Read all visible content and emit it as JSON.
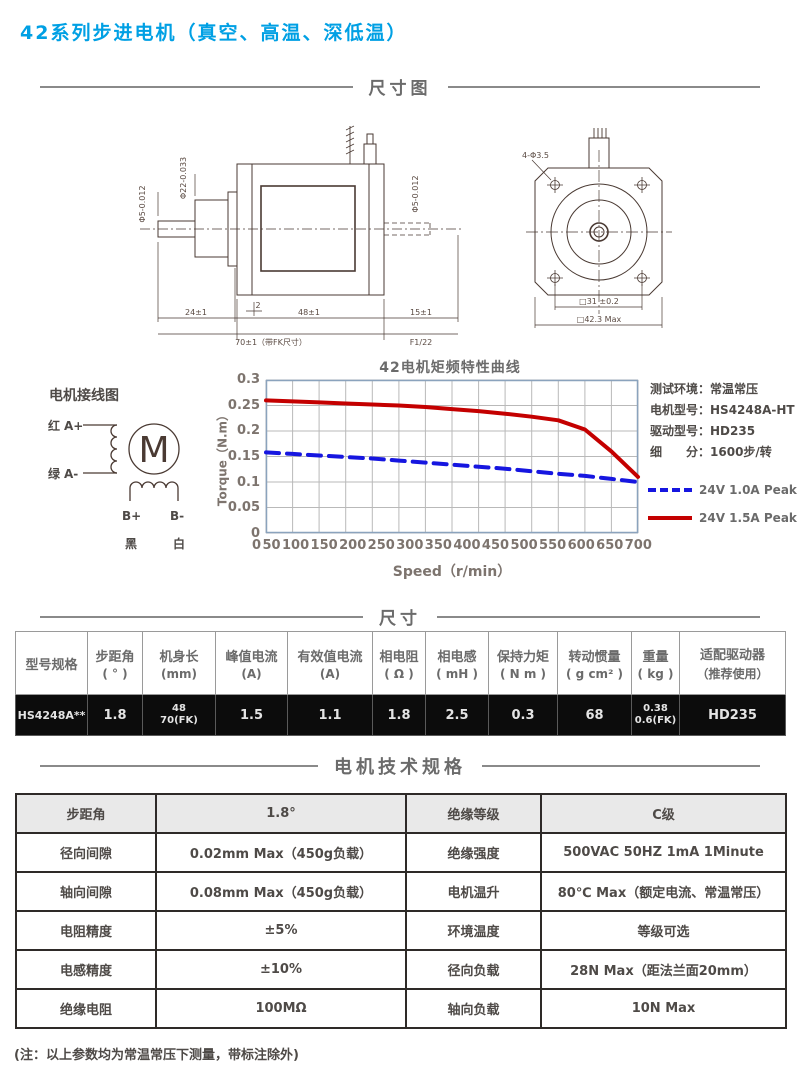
{
  "page": {
    "title": "42系列步进电机（真空、高温、深低温）",
    "footnote": "(注：以上参数均为常温常压下测量，带标注除外)"
  },
  "sections": {
    "dimension_drawing": "尺寸图",
    "dimensions": "尺寸",
    "motor_specs": "电机技术规格"
  },
  "colors": {
    "accent_blue": "#00a0e4",
    "curve_red": "#c40000",
    "curve_blue": "#1616e0",
    "grid_gray": "#b9b9b9",
    "frame_blue_gray": "#8ba3bd"
  },
  "drawing": {
    "side_view": {
      "shaft_dia": "Φ5-0.012",
      "boss_dia": "Φ22-0.033",
      "rear_shaft_dia": "Φ5-0.012",
      "dim_boss": "24±1",
      "dim_plate": "2",
      "dim_body": "48±1",
      "dim_total": "70±1（带FK尺寸）",
      "dim_shaft": "15±1",
      "dim_note": "F1/22"
    },
    "front_view": {
      "hole_label": "4-Φ3.5",
      "hole_pitch": "□31 ±0.2",
      "body_size": "□42.3 Max"
    }
  },
  "wiring": {
    "title": "电机接线图",
    "motor_letter": "M",
    "red": "红",
    "a_plus": "A+",
    "green": "绿",
    "a_minus": "A-",
    "b_plus": "B+",
    "b_minus": "B-",
    "black": "黑",
    "white": "白"
  },
  "chart_info": {
    "rows": [
      {
        "label": "测试环境：",
        "value": "常温常压"
      },
      {
        "label": "电机型号：",
        "value": "HS4248A-HT"
      },
      {
        "label": "驱动型号：",
        "value": "HD235"
      },
      {
        "label": "细　　分：",
        "value": "1600步/转"
      }
    ]
  },
  "chart_data": {
    "type": "line",
    "title": "42电机矩频特性曲线",
    "xlabel": "Speed（r/min）",
    "ylabel": "Torque（N.m）",
    "x": [
      0,
      50,
      100,
      150,
      200,
      250,
      300,
      350,
      400,
      450,
      500,
      550,
      600,
      650,
      700
    ],
    "xlim": [
      0,
      700
    ],
    "ylim": [
      0,
      0.3
    ],
    "y_ticks": [
      0,
      0.05,
      0.1,
      0.15,
      0.2,
      0.25,
      0.3
    ],
    "grid": true,
    "legend_position": "right",
    "series": [
      {
        "name": "24V 1.0A Peak",
        "color": "#1616e0",
        "style": "dashed",
        "values": [
          0.158,
          0.155,
          0.152,
          0.149,
          0.146,
          0.142,
          0.138,
          0.134,
          0.13,
          0.126,
          0.121,
          0.116,
          0.112,
          0.106,
          0.1
        ]
      },
      {
        "name": "24V 1.5A Peak",
        "color": "#c40000",
        "style": "solid",
        "values": [
          0.26,
          0.258,
          0.256,
          0.254,
          0.252,
          0.25,
          0.247,
          0.243,
          0.239,
          0.234,
          0.228,
          0.221,
          0.203,
          0.16,
          0.11
        ]
      }
    ]
  },
  "dim_table": {
    "headers": [
      {
        "label": "型号规格",
        "unit": ""
      },
      {
        "label": "步距角",
        "unit": "( ° )"
      },
      {
        "label": "机身长",
        "unit": "(mm)"
      },
      {
        "label": "峰值电流",
        "unit": "(A)"
      },
      {
        "label": "有效值电流",
        "unit": "(A)"
      },
      {
        "label": "相电阻",
        "unit": "( Ω )"
      },
      {
        "label": "相电感",
        "unit": "( mH )"
      },
      {
        "label": "保持力矩",
        "unit": "( N m )"
      },
      {
        "label": "转动惯量",
        "unit": "( g cm² )"
      },
      {
        "label": "重量",
        "unit": "( kg )"
      },
      {
        "label": "适配驱动器",
        "unit": "（推荐使用）"
      }
    ],
    "rows": [
      [
        "HS4248A**",
        "1.8",
        "48\n70(FK)",
        "1.5",
        "1.1",
        "1.8",
        "2.5",
        "0.3",
        "68",
        "0.38\n0.6(FK)",
        "HD235"
      ]
    ]
  },
  "spec_table": {
    "rows": [
      [
        "步距角",
        "1.8°",
        "绝缘等级",
        "C级"
      ],
      [
        "径向间隙",
        "0.02mm Max（450g负载）",
        "绝缘强度",
        "500VAC 50HZ 1mA 1Minute"
      ],
      [
        "轴向间隙",
        "0.08mm Max（450g负载）",
        "电机温升",
        "80℃ Max（额定电流、常温常压）"
      ],
      [
        "电阻精度",
        "±5%",
        "环境温度",
        "等级可选"
      ],
      [
        "电感精度",
        "±10%",
        "径向负载",
        "28N Max（距法兰面20mm）"
      ],
      [
        "绝缘电阻",
        "100MΩ",
        "轴向负载",
        "10N  Max"
      ]
    ]
  }
}
